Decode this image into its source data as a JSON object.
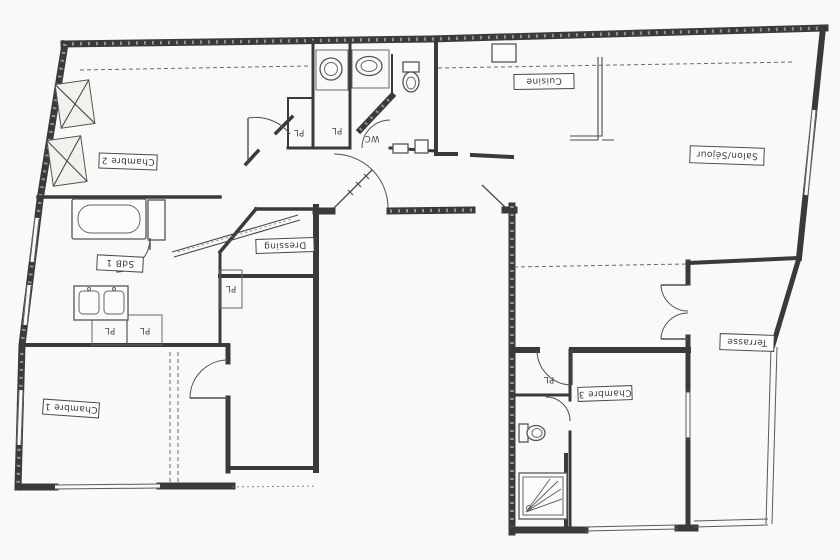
{
  "floor_plan": {
    "paper_color": "#f9f9f7",
    "ink_color": "#3a3a3a",
    "label_rotation_deg": 180,
    "rooms": [
      {
        "id": "chambre-2",
        "label": "Chambre 2"
      },
      {
        "id": "cuisine",
        "label": "Cuisine"
      },
      {
        "id": "salon-sejour",
        "label": "Salon/Séjour"
      },
      {
        "id": "sdb-1",
        "label": "SdB 1"
      },
      {
        "id": "dressing",
        "label": "Dressing"
      },
      {
        "id": "wc",
        "label": "WC"
      },
      {
        "id": "chambre-1",
        "label": "Chambre 1"
      },
      {
        "id": "chambre-3",
        "label": "Chambre 3"
      },
      {
        "id": "terrasse",
        "label": "Terrasse"
      }
    ],
    "closets": [
      {
        "label": "PL"
      },
      {
        "label": "PL"
      },
      {
        "label": "PL"
      },
      {
        "label": "PL"
      },
      {
        "label": "PL"
      },
      {
        "label": "PL"
      }
    ]
  }
}
